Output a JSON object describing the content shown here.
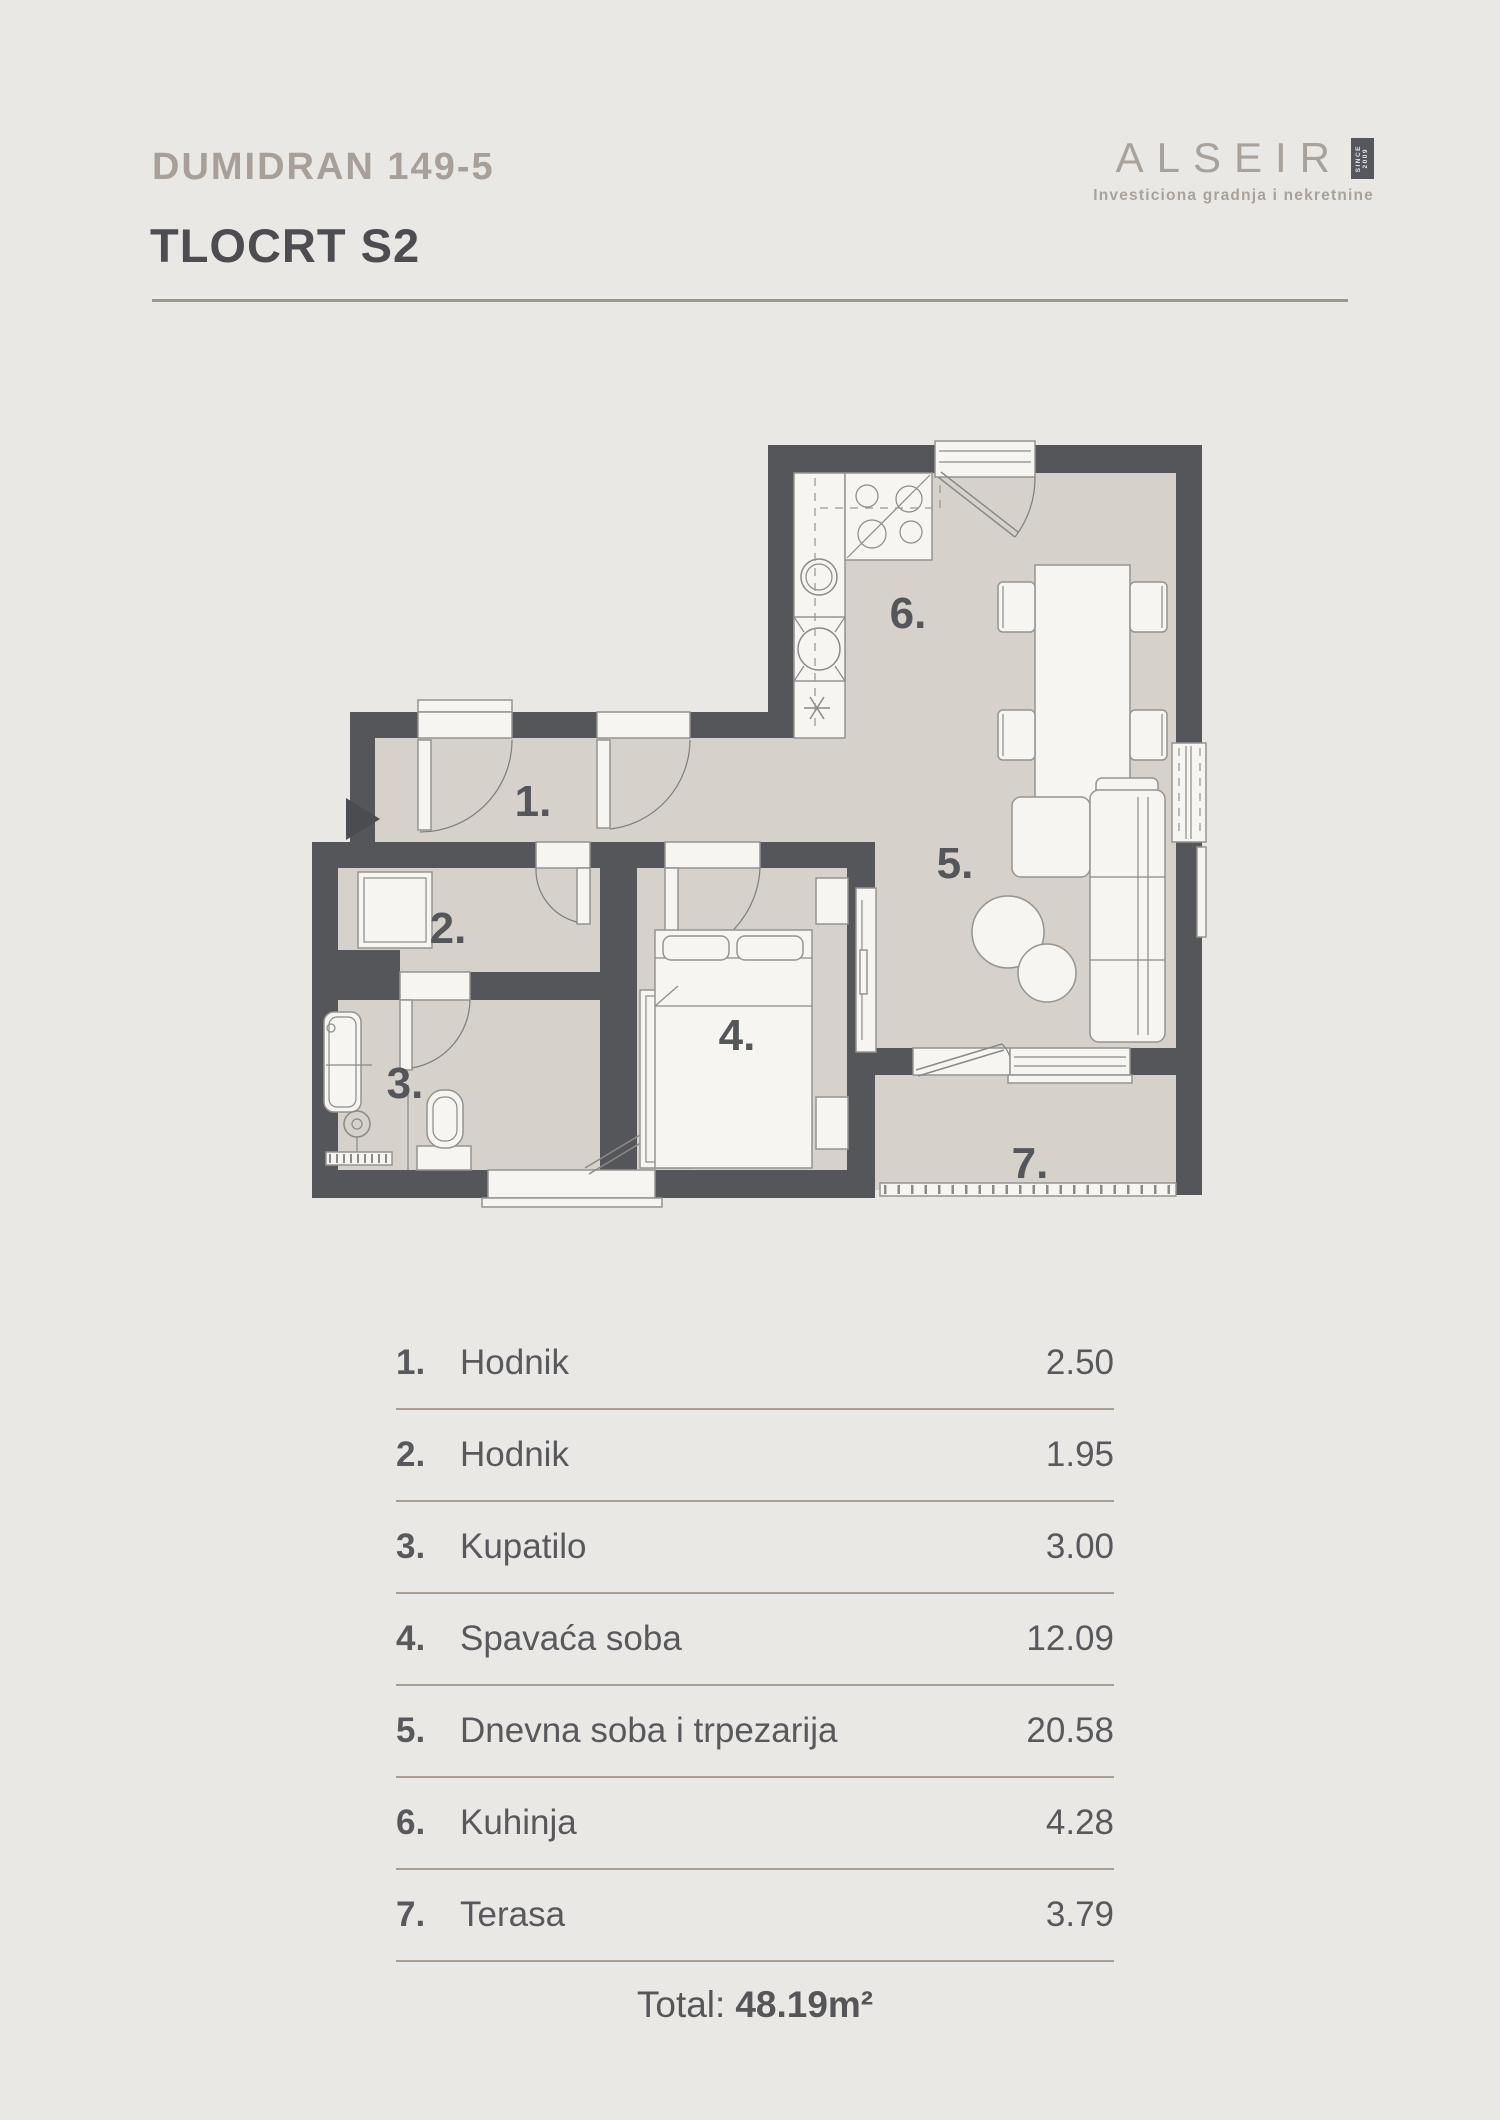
{
  "header": {
    "project": "DUMIDRAN 149-5",
    "title": "TLOCRT S2"
  },
  "logo": {
    "name": "ALSEIR",
    "since_word": "SINCE",
    "since_year": "2009",
    "tagline": "Investiciona gradnja i nekretnine"
  },
  "plan": {
    "labels": [
      {
        "num": "1."
      },
      {
        "num": "2."
      },
      {
        "num": "3."
      },
      {
        "num": "4."
      },
      {
        "num": "5."
      },
      {
        "num": "6."
      },
      {
        "num": "7."
      }
    ]
  },
  "legend": {
    "rows": [
      {
        "num": "1.",
        "label": "Hodnik",
        "value": "2.50"
      },
      {
        "num": "2.",
        "label": "Hodnik",
        "value": "1.95"
      },
      {
        "num": "3.",
        "label": "Kupatilo",
        "value": "3.00"
      },
      {
        "num": "4.",
        "label": "Spavaća soba",
        "value": "12.09"
      },
      {
        "num": "5.",
        "label": "Dnevna soba i trpezarija",
        "value": "20.58"
      },
      {
        "num": "6.",
        "label": "Kuhinja",
        "value": "4.28"
      },
      {
        "num": "7.",
        "label": "Terasa",
        "value": "3.79"
      }
    ],
    "total_label": "Total:",
    "total_value": "48.19m²"
  },
  "colors": {
    "background": "#e9e8e5",
    "wall": "#54565a",
    "floor": "#d6d1ca",
    "accent_text": "#a8a098",
    "heading": "#4c4c51",
    "divider": "#a89f92"
  }
}
